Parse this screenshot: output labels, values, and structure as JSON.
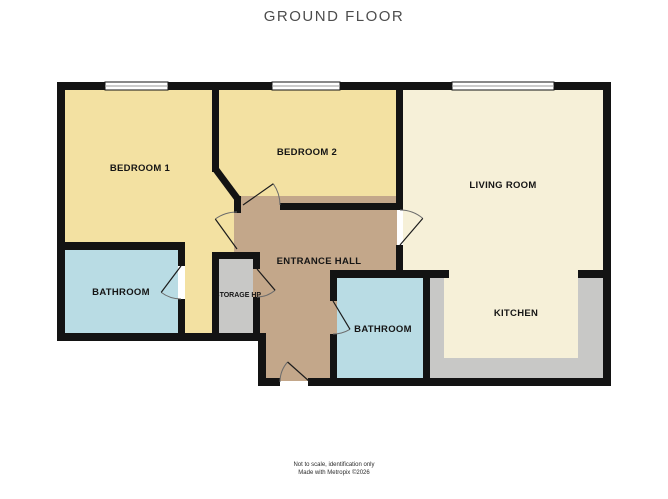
{
  "title": "GROUND FLOOR",
  "rooms": {
    "bedroom1": {
      "label": "BEDROOM 1"
    },
    "bedroom2": {
      "label": "BEDROOM 2"
    },
    "living_room": {
      "label": "LIVING ROOM"
    },
    "bathroom1": {
      "label": "BATHROOM"
    },
    "storage": {
      "label": "STORAGE HP"
    },
    "entrance_hall": {
      "label": "ENTRANCE HALL"
    },
    "bathroom2": {
      "label": "BATHROOM"
    },
    "kitchen": {
      "label": "KITCHEN"
    }
  },
  "footer": {
    "line1": "Not to scale, identification only",
    "line2": "Made with Metropix ©2026"
  },
  "colors": {
    "wall": "#131313",
    "bedroom": "#F3E1A2",
    "living": "#F6F0D8",
    "hall": "#C3A78A",
    "bathroom": "#B9DCE4",
    "gray": "#C8C8C6",
    "window": "#FFFFFF"
  }
}
